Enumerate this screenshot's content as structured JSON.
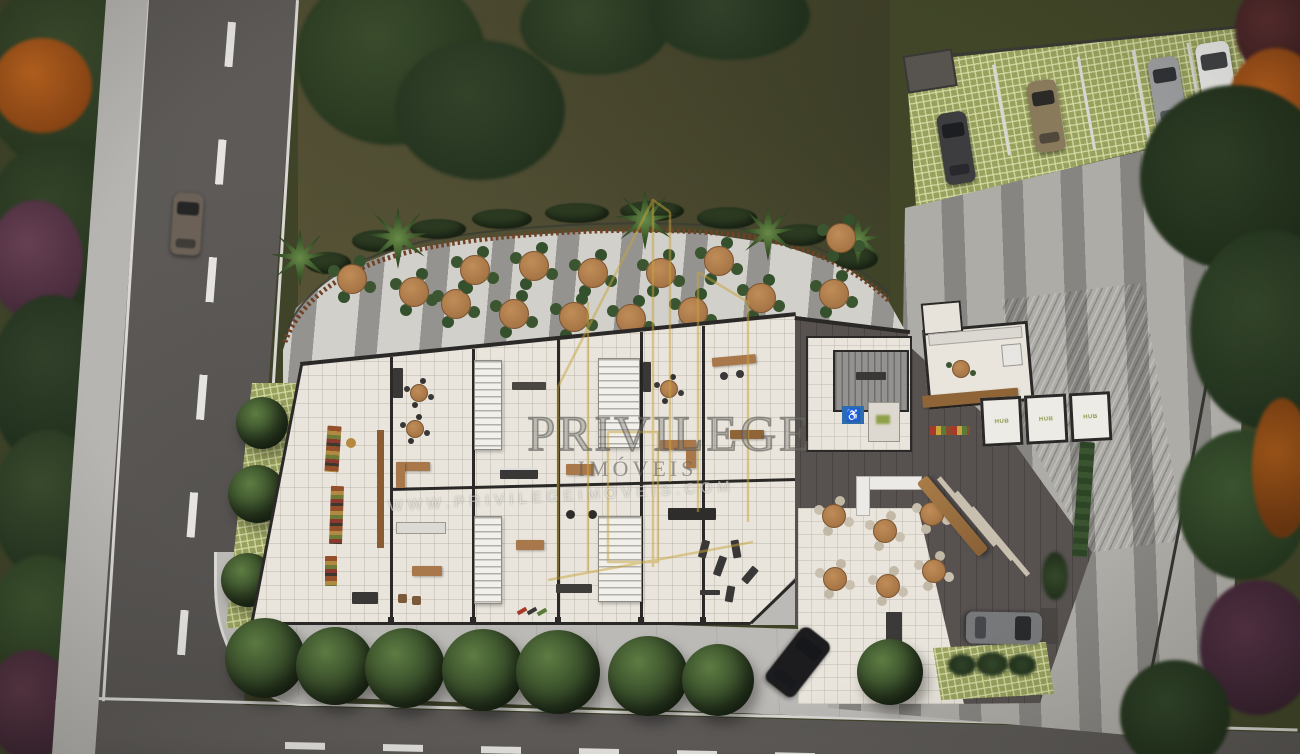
{
  "scene": {
    "title": "Aerial site-plan render",
    "description": "Top-down 3D architectural rendering of a commercial ground floor: outdoor terrace with round tables, retail units with mezzanine stairs, lobby with stair and accessibility sign, HUB booths, restaurant seating, grass-grid parking with cars, surrounding streets, sidewalk trees and landscaping"
  },
  "watermark": {
    "brand": "PRIVILEGE",
    "division": "IMÓVEIS",
    "website": "WWW.PRIVILEGEIMOVEIS.COM",
    "logo": "gold-building-outline-logo",
    "logo_color": "#c8a43c"
  },
  "labels": {
    "hub_booth": "HUB",
    "accessibility_icon": "♿"
  },
  "palette": {
    "asphalt": "#5b5856",
    "road_marking": "#e6e4e0",
    "sidewalk": "#bcbab6",
    "terrace_light": "#d2d0cb",
    "terrace_stripe": "#8d8b88",
    "floor_cream": "#e9e5dc",
    "wall_dark": "#2b2927",
    "lobby_floor": "#575250",
    "roof_gray": "#9c9b98",
    "grass_grid": "#99a15e",
    "lawn": "#4f4c31",
    "tree_green": "#36492a",
    "tree_orange": "#a85618",
    "shrub_purple": "#553246",
    "wood": "#a9784a",
    "chair_green": "#3a5530",
    "chair_beige": "#c9bfae",
    "accessibility_blue": "#2e6cb0"
  },
  "inventory": {
    "terrace_tables": 15,
    "terrace_chairs_per_table": 4,
    "restaurant_tables": 6,
    "cafe_tables": 3,
    "parking_cars": 4,
    "street_cars": 3,
    "sidewalk_trees": 8,
    "hub_booths": 3,
    "palm_trees": 5,
    "retail_units": 10,
    "stair_flights": 4
  }
}
